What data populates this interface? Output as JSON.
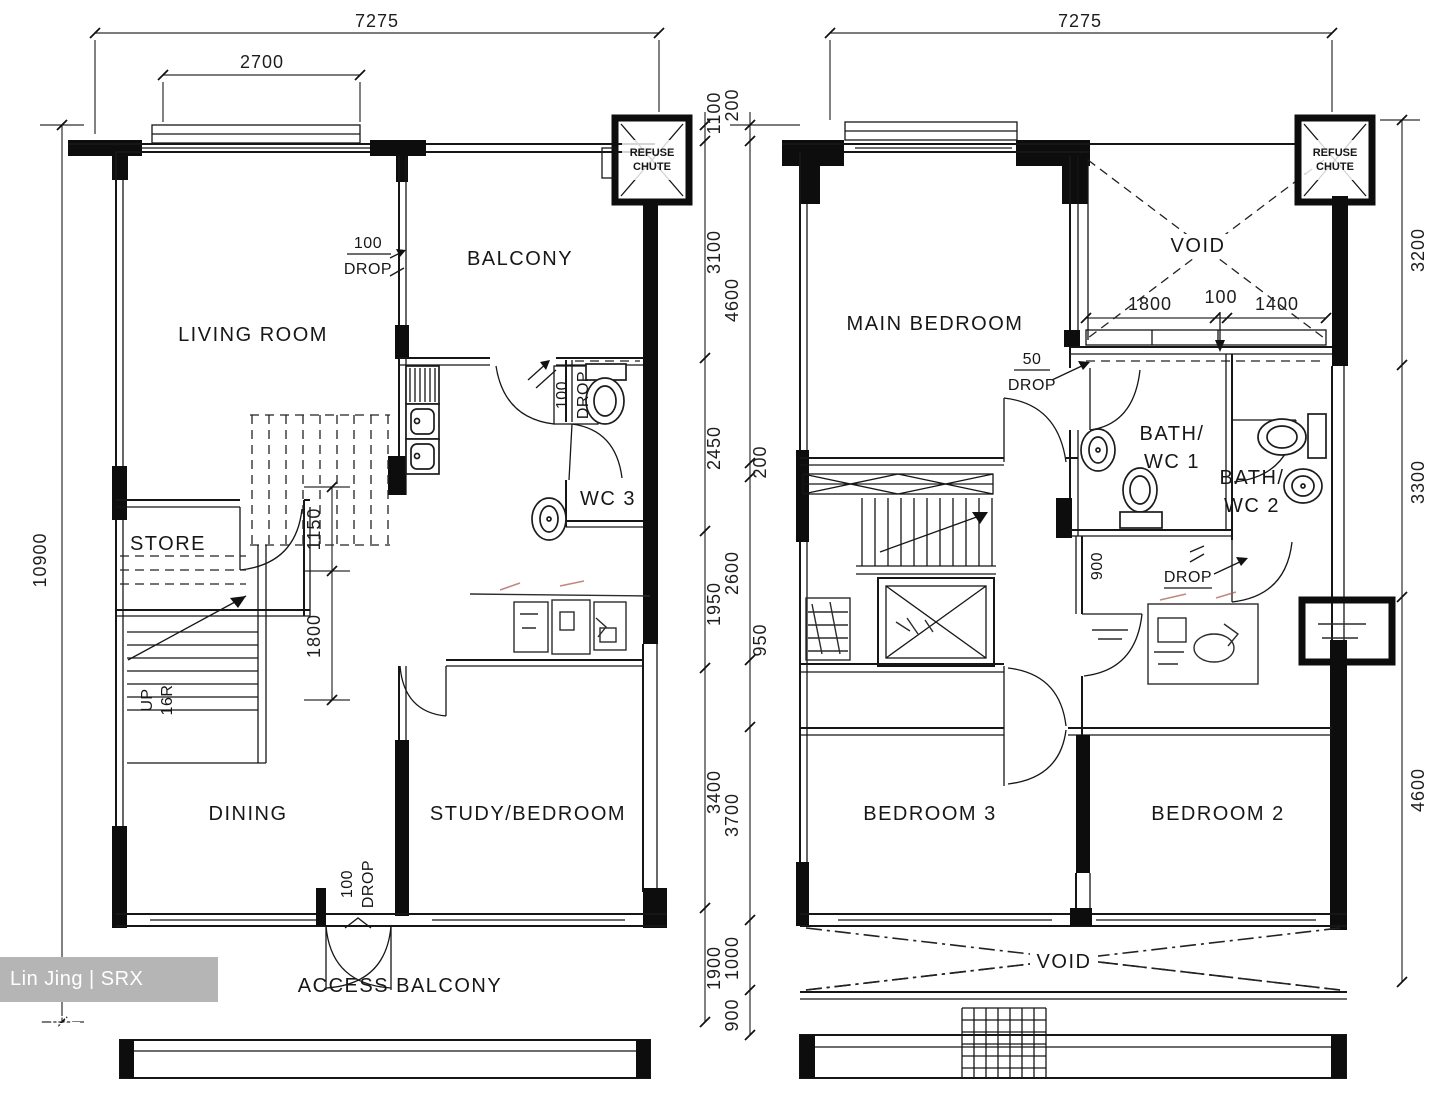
{
  "watermark": {
    "label": "Lin Jing | SRX PROPERTY"
  },
  "left_plan": {
    "rooms": {
      "living": "LIVING ROOM",
      "balcony": "BALCONY",
      "store": "STORE",
      "wc3": "WC 3",
      "dining": "DINING",
      "study": "STUDY/BEDROOM",
      "access_balcony": "ACCESS BALCONY"
    },
    "refuse_chute": {
      "line1": "REFUSE",
      "line2": "CHUTE"
    },
    "stairs": {
      "direction": "UP",
      "risers": "16R"
    },
    "drops": {
      "balcony_wall": {
        "num": "100",
        "word": "DROP"
      },
      "kitchen_door": {
        "num": "100",
        "word": "DROP"
      },
      "entry_door": {
        "num": "100",
        "word": "DROP"
      }
    },
    "dims": {
      "total_width": "7275",
      "bay_window": "2700",
      "total_height": "10900",
      "right_column": [
        "1100",
        "3100",
        "2450",
        "1950",
        "3400",
        "1900"
      ],
      "stair_column": [
        "1150",
        "1800"
      ]
    }
  },
  "right_plan": {
    "rooms": {
      "main_bedroom": "MAIN BEDROOM",
      "void_upper": "VOID",
      "bath1_line1": "BATH/",
      "bath1_line2": "WC 1",
      "bath2_line1": "BATH/",
      "bath2_line2": "WC 2",
      "bedroom3": "BEDROOM 3",
      "bedroom2": "BEDROOM 2",
      "void_lower": "VOID"
    },
    "refuse_chute": {
      "line1": "REFUSE",
      "line2": "CHUTE"
    },
    "drops": {
      "bath1": {
        "num": "50",
        "word": "DROP"
      },
      "corridor": {
        "num": "900",
        "word": "DROP"
      }
    },
    "dims": {
      "total_width": "7275",
      "left_column": [
        "200",
        "4600",
        "200",
        "2600",
        "950",
        "3700",
        "1000",
        "900"
      ],
      "right_column": [
        "3200",
        "3300",
        "4600"
      ],
      "void_strip": [
        "1800",
        "100",
        "1400"
      ]
    }
  }
}
